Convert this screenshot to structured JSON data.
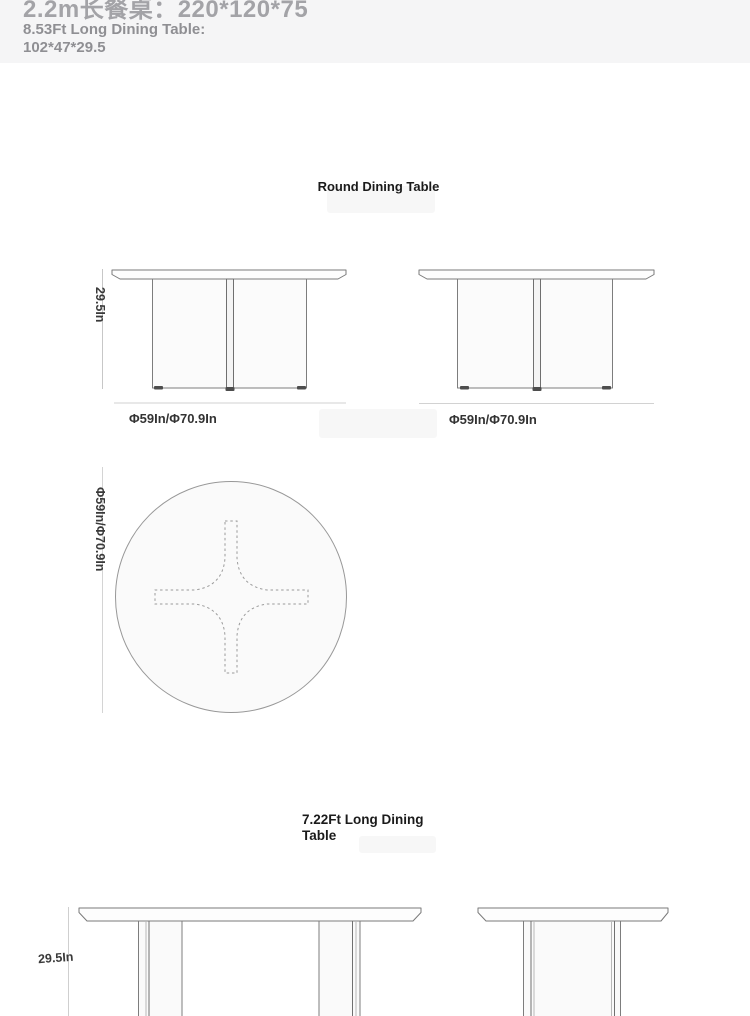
{
  "header": {
    "title_cn": "2.2m长餐桌：220*120*75",
    "subtitle_line1": "8.53Ft Long Dining Table:",
    "subtitle_line2": "102*47*29.5"
  },
  "sections": {
    "round": {
      "title": "Round Dining Table",
      "front_view": {
        "height_label": "29.5In",
        "diameter_label": "Φ59In/Φ70.9In"
      },
      "side_view": {
        "diameter_label": "Φ59In/Φ70.9In"
      },
      "top_view": {
        "diameter_label": "Φ59In/Φ70.9In"
      }
    },
    "long": {
      "title": "7.22Ft Long Dining Table",
      "front_view": {
        "height_label": "29.5In"
      }
    }
  },
  "colors": {
    "header_bg": "#f5f5f6",
    "page_bg": "#ffffff",
    "drawing_outline": "#7a7a7a",
    "dimension_line": "#d2d2d2",
    "label_text": "#3a3a3a"
  }
}
